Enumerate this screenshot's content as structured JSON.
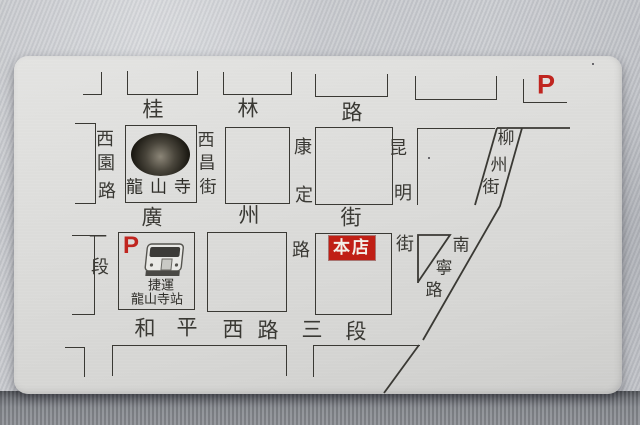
{
  "colors": {
    "accent_red": "#c0251f",
    "map_ink": "#3a3934",
    "card": "#dcdcda",
    "fabric": "#c6c8cc"
  },
  "badges": {
    "parking_top": "P",
    "parking_station": "P",
    "shop": "本店"
  },
  "landmarks": {
    "temple_name": "龍山寺",
    "station_line1": "捷運",
    "station_line2": "龍山寺站"
  },
  "streets": {
    "guilin": {
      "name": "桂林路",
      "chars": [
        "桂",
        "林",
        "路"
      ]
    },
    "guangzhou": {
      "name": "廣州街",
      "chars": [
        "廣",
        "州",
        "街"
      ]
    },
    "heping": {
      "name": "和平西路三段",
      "chars": [
        "和",
        "平",
        "西",
        "路",
        "三",
        "段"
      ]
    },
    "xiyuan": {
      "name": "西園路",
      "chars": [
        "西",
        "園",
        "路"
      ]
    },
    "xiyuan_section": {
      "name": "一段",
      "chars": [
        "一",
        "段"
      ]
    },
    "xichang": {
      "name": "西昌街",
      "chars": [
        "西",
        "昌",
        "街"
      ]
    },
    "kangding": {
      "name": "康定路",
      "upper": [
        "康",
        "定"
      ],
      "lower": "路"
    },
    "kunming": {
      "name": "昆明街",
      "upper": [
        "昆",
        "明"
      ],
      "lower": "街"
    },
    "liuzhou": {
      "name": "柳州街",
      "chars": [
        "柳",
        "州",
        "街"
      ]
    },
    "nanning": {
      "name": "南寧路",
      "chars": [
        "南",
        "寧",
        "路"
      ]
    }
  }
}
